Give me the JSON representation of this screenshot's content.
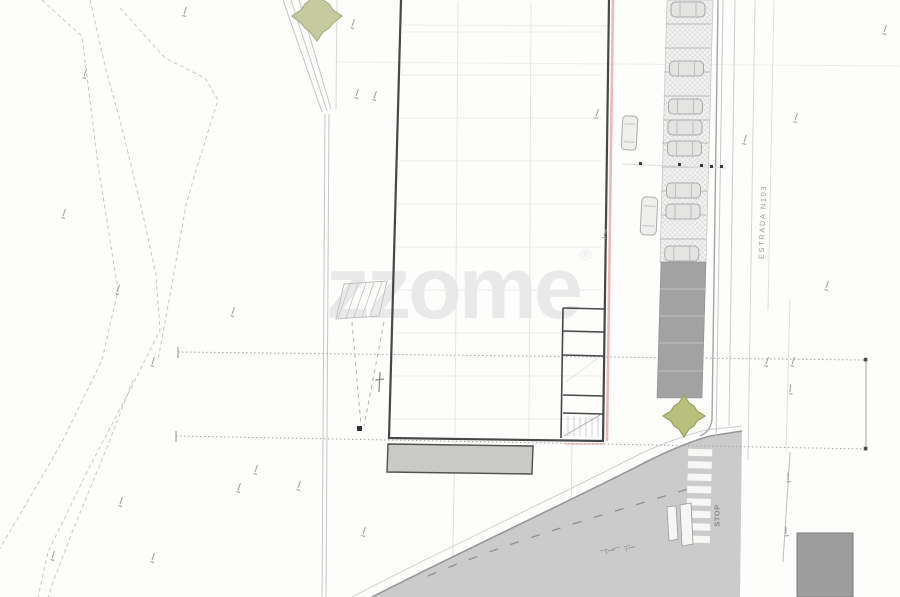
{
  "plan": {
    "watermark": {
      "text": "zzome",
      "registered_mark": "®"
    },
    "labels": {
      "road_name": "ESTRADA N103",
      "stop_marking": "STOP"
    },
    "counts": {
      "hatched_parking_spaces": 11,
      "cars_in_parking_bays": 8,
      "cars_on_driveway": 2,
      "crosswalk_stripes": 8,
      "trees": 2
    },
    "colors": {
      "paper": "#fdfdfc",
      "building_wall": "#474747",
      "boundary_pink": "#e9aaaa",
      "road_fill": "#cbcbcb",
      "road_edge": "#969696",
      "parking_block": "#a2a2a2",
      "apron_fill": "#c9cac6",
      "structure_fill": "#9d9d9d",
      "tree_light": "#c6cb9f",
      "tree_olive": "#b9c07c",
      "contour_line": "#c8c8c8",
      "dimension_line": "#a3a3a3",
      "watermark": "#e9e9e9"
    }
  }
}
